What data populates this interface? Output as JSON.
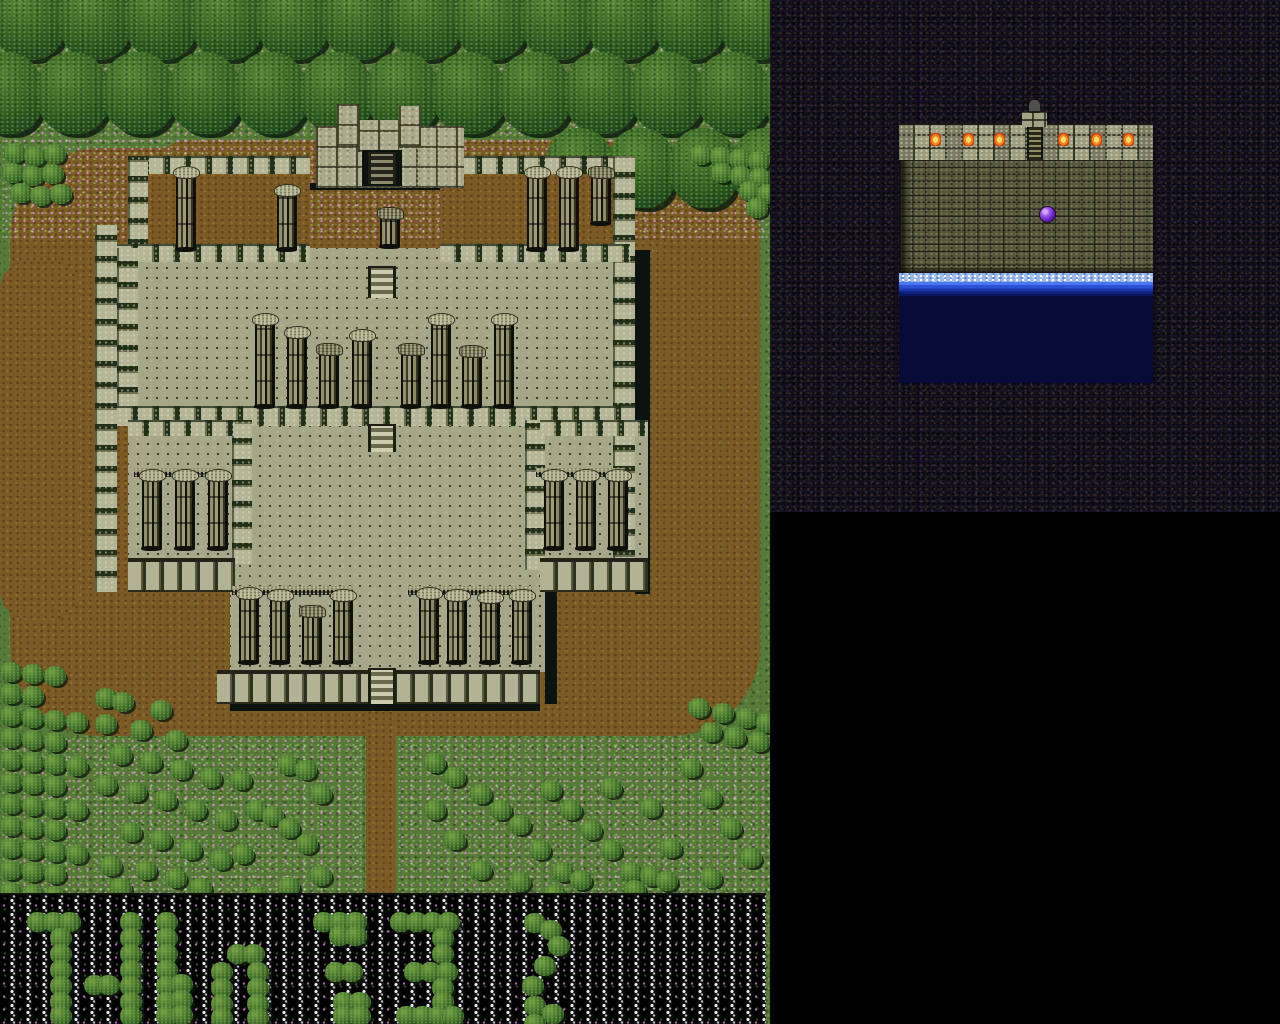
{
  "screen": {
    "width": 1280,
    "height": 1024
  },
  "palette": {
    "grass": "#57793a",
    "dirt": "#7a5a25",
    "tree_dark": "#173819",
    "tree_light": "#568536",
    "stone_light": "#b4b496",
    "stone_mid": "#a6a689",
    "stone_dark": "#585840",
    "shadow": "#0c130e",
    "cave_base": "#151120",
    "brick": "#56563c",
    "water_deep": "#070b36",
    "water_bright": "#2c50d4",
    "foam": "#9cb8ea",
    "orb_purple": "#6b20c0",
    "torch_flame": "#f08622",
    "flower_pink": "#d78cd2",
    "flowerbed_black": "#040404",
    "flowerbed_star": "#eeeeee"
  },
  "overworld": {
    "x": 0,
    "y": 0,
    "width": 770,
    "height": 1024,
    "terrain": {
      "dirt_areas": [
        {
          "x": 10,
          "y": 148,
          "w": 750,
          "h": 588,
          "r": 90
        },
        {
          "x": 0,
          "y": 260,
          "w": 80,
          "h": 360,
          "r": 30
        },
        {
          "x": 150,
          "y": 140,
          "w": 520,
          "h": 120,
          "r": 40
        },
        {
          "x": 366,
          "y": 704,
          "w": 30,
          "h": 190,
          "r": 0
        }
      ],
      "flower_bands": [
        {
          "x": 0,
          "y": 0,
          "w": 770,
          "h": 240
        },
        {
          "x": 0,
          "y": 736,
          "w": 366,
          "h": 157
        },
        {
          "x": 396,
          "y": 736,
          "w": 374,
          "h": 157
        }
      ],
      "tree_rows": [
        {
          "x": -8,
          "y": -22,
          "cols": 12,
          "step": 66,
          "w": 74,
          "h": 82
        },
        {
          "x": -30,
          "y": 52,
          "cols": 13,
          "step": 66,
          "w": 74,
          "h": 82
        },
        {
          "x": 545,
          "y": 128,
          "cols": 4,
          "step": 62,
          "w": 70,
          "h": 80
        }
      ],
      "flowerbed_strip": {
        "x": 0,
        "y": 893,
        "w": 766,
        "h": 131
      }
    },
    "castle": {
      "sections": [
        {
          "t": "crenelv",
          "x": 95,
          "y": 225,
          "w": 22,
          "h": 367
        },
        {
          "t": "shadow",
          "x": 635,
          "y": 250,
          "w": 15,
          "h": 344
        },
        {
          "t": "shadow",
          "x": 545,
          "y": 592,
          "w": 12,
          "h": 112
        },
        {
          "t": "shadow",
          "x": 230,
          "y": 704,
          "w": 310,
          "h": 7
        },
        {
          "t": "shadow",
          "x": 305,
          "y": 183,
          "w": 165,
          "h": 7
        },
        {
          "t": "dirtfloor",
          "x": 128,
          "y": 163,
          "w": 182,
          "h": 92
        },
        {
          "t": "dirtfloor",
          "x": 440,
          "y": 163,
          "w": 173,
          "h": 92
        },
        {
          "t": "floor",
          "x": 117,
          "y": 248,
          "w": 518,
          "h": 162
        },
        {
          "t": "floor",
          "x": 230,
          "y": 426,
          "w": 315,
          "h": 246
        },
        {
          "t": "floor",
          "x": 128,
          "y": 424,
          "w": 107,
          "h": 140
        },
        {
          "t": "floor",
          "x": 540,
          "y": 424,
          "w": 108,
          "h": 140
        },
        {
          "t": "crenelh",
          "x": 128,
          "y": 156,
          "w": 182,
          "h": 18
        },
        {
          "t": "crenelh",
          "x": 440,
          "y": 156,
          "w": 173,
          "h": 18
        },
        {
          "t": "crenelv",
          "x": 128,
          "y": 156,
          "w": 20,
          "h": 104
        },
        {
          "t": "crenelv",
          "x": 613,
          "y": 156,
          "w": 22,
          "h": 436
        },
        {
          "t": "crenelh",
          "x": 117,
          "y": 244,
          "w": 193,
          "h": 18
        },
        {
          "t": "crenelh",
          "x": 440,
          "y": 244,
          "w": 190,
          "h": 18
        },
        {
          "t": "crenelv",
          "x": 117,
          "y": 248,
          "w": 21,
          "h": 160
        },
        {
          "t": "crenelh",
          "x": 117,
          "y": 406,
          "w": 518,
          "h": 20
        },
        {
          "t": "crenelv",
          "x": 232,
          "y": 420,
          "w": 20,
          "h": 144
        },
        {
          "t": "crenelv",
          "x": 525,
          "y": 420,
          "w": 20,
          "h": 150
        },
        {
          "t": "crenelh",
          "x": 128,
          "y": 420,
          "w": 107,
          "h": 16
        },
        {
          "t": "crenelh",
          "x": 540,
          "y": 420,
          "w": 108,
          "h": 16
        },
        {
          "t": "wallface",
          "x": 128,
          "y": 558,
          "w": 107,
          "h": 34
        },
        {
          "t": "wallface",
          "x": 540,
          "y": 558,
          "w": 108,
          "h": 34
        },
        {
          "t": "wallface",
          "x": 217,
          "y": 670,
          "w": 323,
          "h": 34
        },
        {
          "t": "blocks",
          "x": 316,
          "y": 126,
          "w": 148,
          "h": 62
        },
        {
          "t": "blocks",
          "x": 337,
          "y": 104,
          "w": 22,
          "h": 42
        },
        {
          "t": "blocks",
          "x": 399,
          "y": 106,
          "w": 22,
          "h": 40
        },
        {
          "t": "blocks",
          "x": 358,
          "y": 120,
          "w": 41,
          "h": 32
        },
        {
          "t": "gate",
          "x": 362,
          "y": 150,
          "w": 40,
          "h": 36
        }
      ],
      "lintels": [
        {
          "x": 134,
          "y": 468,
          "w": 88,
          "h": 9
        },
        {
          "x": 536,
          "y": 468,
          "w": 88,
          "h": 9
        },
        {
          "x": 232,
          "y": 586,
          "w": 122,
          "h": 9
        },
        {
          "x": 408,
          "y": 586,
          "w": 124,
          "h": 9
        }
      ],
      "columns": [
        {
          "x": 176,
          "y": 175,
          "h": 74
        },
        {
          "x": 277,
          "y": 193,
          "h": 56
        },
        {
          "x": 527,
          "y": 175,
          "h": 74
        },
        {
          "x": 559,
          "y": 175,
          "h": 74
        },
        {
          "x": 591,
          "y": 175,
          "h": 48,
          "broken": true
        },
        {
          "x": 380,
          "y": 216,
          "h": 30,
          "broken": true
        },
        {
          "x": 255,
          "y": 322,
          "h": 84
        },
        {
          "x": 287,
          "y": 335,
          "h": 71
        },
        {
          "x": 319,
          "y": 352,
          "h": 54,
          "broken": true
        },
        {
          "x": 352,
          "y": 338,
          "h": 68
        },
        {
          "x": 401,
          "y": 352,
          "h": 54,
          "broken": true
        },
        {
          "x": 431,
          "y": 322,
          "h": 84
        },
        {
          "x": 462,
          "y": 354,
          "h": 52,
          "broken": true
        },
        {
          "x": 494,
          "y": 322,
          "h": 84
        },
        {
          "x": 142,
          "y": 478,
          "h": 70
        },
        {
          "x": 175,
          "y": 478,
          "h": 70
        },
        {
          "x": 208,
          "y": 478,
          "h": 70
        },
        {
          "x": 544,
          "y": 478,
          "h": 70
        },
        {
          "x": 576,
          "y": 478,
          "h": 70
        },
        {
          "x": 608,
          "y": 478,
          "h": 70
        },
        {
          "x": 239,
          "y": 596,
          "h": 66
        },
        {
          "x": 270,
          "y": 598,
          "h": 64
        },
        {
          "x": 302,
          "y": 614,
          "h": 48,
          "broken": true
        },
        {
          "x": 333,
          "y": 598,
          "h": 64
        },
        {
          "x": 419,
          "y": 596,
          "h": 66
        },
        {
          "x": 447,
          "y": 598,
          "h": 64
        },
        {
          "x": 480,
          "y": 600,
          "h": 62
        },
        {
          "x": 512,
          "y": 598,
          "h": 64
        }
      ],
      "stairs": [
        {
          "x": 368,
          "y": 152,
          "w": 28,
          "h": 32,
          "dark": true
        },
        {
          "x": 368,
          "y": 266,
          "w": 28,
          "h": 32
        },
        {
          "x": 368,
          "y": 424,
          "w": 28,
          "h": 28
        },
        {
          "x": 368,
          "y": 668,
          "w": 28,
          "h": 36
        }
      ]
    },
    "bushes": [
      [
        4,
        143
      ],
      [
        24,
        146
      ],
      [
        44,
        144
      ],
      [
        2,
        163
      ],
      [
        22,
        166
      ],
      [
        42,
        164
      ],
      [
        10,
        183
      ],
      [
        30,
        186
      ],
      [
        50,
        184
      ],
      [
        690,
        145
      ],
      [
        710,
        147
      ],
      [
        729,
        149
      ],
      [
        748,
        151
      ],
      [
        711,
        163
      ],
      [
        730,
        166
      ],
      [
        749,
        168
      ],
      [
        739,
        181
      ],
      [
        757,
        184
      ],
      [
        746,
        198
      ],
      [
        0,
        662
      ],
      [
        22,
        664
      ],
      [
        44,
        666
      ],
      [
        0,
        684
      ],
      [
        22,
        686
      ],
      [
        0,
        706
      ],
      [
        22,
        708
      ],
      [
        44,
        710
      ],
      [
        66,
        712
      ],
      [
        0,
        728
      ],
      [
        22,
        730
      ],
      [
        44,
        732
      ],
      [
        0,
        750
      ],
      [
        22,
        752
      ],
      [
        44,
        754
      ],
      [
        66,
        756
      ],
      [
        0,
        772
      ],
      [
        22,
        774
      ],
      [
        44,
        776
      ],
      [
        0,
        794
      ],
      [
        22,
        796
      ],
      [
        44,
        798
      ],
      [
        66,
        800
      ],
      [
        0,
        816
      ],
      [
        22,
        818
      ],
      [
        44,
        820
      ],
      [
        0,
        838
      ],
      [
        22,
        840
      ],
      [
        44,
        842
      ],
      [
        66,
        844
      ],
      [
        0,
        860
      ],
      [
        22,
        862
      ],
      [
        44,
        864
      ],
      [
        0,
        882
      ],
      [
        22,
        884
      ],
      [
        44,
        886
      ],
      [
        95,
        688
      ],
      [
        112,
        692
      ],
      [
        150,
        700
      ],
      [
        95,
        714
      ],
      [
        130,
        720
      ],
      [
        165,
        730
      ],
      [
        110,
        745
      ],
      [
        140,
        752
      ],
      [
        170,
        760
      ],
      [
        200,
        768
      ],
      [
        95,
        775
      ],
      [
        125,
        782
      ],
      [
        155,
        790
      ],
      [
        185,
        800
      ],
      [
        215,
        810
      ],
      [
        120,
        822
      ],
      [
        150,
        830
      ],
      [
        180,
        840
      ],
      [
        210,
        850
      ],
      [
        135,
        860
      ],
      [
        165,
        868
      ],
      [
        100,
        856
      ],
      [
        230,
        770
      ],
      [
        246,
        800
      ],
      [
        262,
        806
      ],
      [
        278,
        818
      ],
      [
        296,
        834
      ],
      [
        232,
        844
      ],
      [
        310,
        866
      ],
      [
        278,
        877
      ],
      [
        246,
        886
      ],
      [
        277,
        755
      ],
      [
        295,
        760
      ],
      [
        310,
        784
      ],
      [
        110,
        878
      ],
      [
        190,
        878
      ],
      [
        424,
        753
      ],
      [
        444,
        767
      ],
      [
        470,
        784
      ],
      [
        490,
        800
      ],
      [
        509,
        815
      ],
      [
        444,
        830
      ],
      [
        529,
        840
      ],
      [
        470,
        860
      ],
      [
        509,
        872
      ],
      [
        552,
        862
      ],
      [
        570,
        870
      ],
      [
        620,
        862
      ],
      [
        640,
        866
      ],
      [
        656,
        871
      ],
      [
        600,
        778
      ],
      [
        640,
        798
      ],
      [
        680,
        758
      ],
      [
        700,
        788
      ],
      [
        720,
        818
      ],
      [
        660,
        838
      ],
      [
        740,
        848
      ],
      [
        700,
        868
      ],
      [
        424,
        800
      ],
      [
        540,
        780
      ],
      [
        560,
        800
      ],
      [
        580,
        820
      ],
      [
        600,
        840
      ],
      [
        624,
        880
      ],
      [
        544,
        884
      ],
      [
        688,
        698
      ],
      [
        712,
        703
      ],
      [
        736,
        708
      ],
      [
        756,
        713
      ],
      [
        700,
        722
      ],
      [
        724,
        727
      ],
      [
        748,
        732
      ]
    ],
    "flowerbed_bushes": [
      [
        27,
        912
      ],
      [
        43,
        912
      ],
      [
        59,
        912
      ],
      [
        50,
        928
      ],
      [
        50,
        944
      ],
      [
        50,
        960
      ],
      [
        50,
        976
      ],
      [
        50,
        992
      ],
      [
        50,
        1006
      ],
      [
        84,
        975
      ],
      [
        98,
        975
      ],
      [
        120,
        912
      ],
      [
        120,
        928
      ],
      [
        120,
        944
      ],
      [
        120,
        960
      ],
      [
        120,
        976
      ],
      [
        120,
        992
      ],
      [
        120,
        1006
      ],
      [
        156,
        912
      ],
      [
        156,
        928
      ],
      [
        156,
        944
      ],
      [
        156,
        960
      ],
      [
        156,
        976
      ],
      [
        156,
        992
      ],
      [
        156,
        1006
      ],
      [
        171,
        974
      ],
      [
        171,
        990
      ],
      [
        171,
        1005
      ],
      [
        227,
        944
      ],
      [
        243,
        944
      ],
      [
        211,
        962
      ],
      [
        211,
        978
      ],
      [
        211,
        994
      ],
      [
        211,
        1008
      ],
      [
        247,
        962
      ],
      [
        247,
        978
      ],
      [
        247,
        994
      ],
      [
        247,
        1008
      ],
      [
        313,
        912
      ],
      [
        329,
        912
      ],
      [
        345,
        912
      ],
      [
        329,
        926
      ],
      [
        345,
        926
      ],
      [
        325,
        962
      ],
      [
        341,
        962
      ],
      [
        333,
        992
      ],
      [
        349,
        992
      ],
      [
        333,
        1006
      ],
      [
        349,
        1006
      ],
      [
        390,
        912
      ],
      [
        406,
        912
      ],
      [
        422,
        912
      ],
      [
        438,
        912
      ],
      [
        432,
        928
      ],
      [
        432,
        944
      ],
      [
        404,
        962
      ],
      [
        420,
        962
      ],
      [
        436,
        962
      ],
      [
        432,
        978
      ],
      [
        432,
        992
      ],
      [
        396,
        1006
      ],
      [
        412,
        1006
      ],
      [
        428,
        1006
      ],
      [
        442,
        1006
      ],
      [
        524,
        913
      ],
      [
        540,
        920
      ],
      [
        548,
        936
      ],
      [
        534,
        956
      ],
      [
        522,
        976
      ],
      [
        524,
        996
      ],
      [
        542,
        1004
      ],
      [
        524,
        1014
      ]
    ]
  },
  "side_view": {
    "cave_panel": {
      "x": 770,
      "y": 0,
      "w": 510,
      "h": 512
    },
    "black_area": {
      "x": 770,
      "y": 512,
      "w": 510,
      "h": 512
    },
    "room": {
      "x": 899,
      "y": 100,
      "w": 254,
      "h": 283,
      "wall_band": {
        "x": 0,
        "y": 23,
        "w": 254,
        "h": 37
      },
      "torches": {
        "count": 6,
        "centers_x": [
          36,
          69,
          100,
          164,
          197,
          229
        ],
        "top_y": 33
      },
      "chimney": {
        "x": 123,
        "y": 12,
        "w": 25,
        "h": 15
      },
      "chimney_cap": {
        "x": 130,
        "y": 0,
        "w": 11,
        "h": 13
      },
      "ladder": {
        "x": 128,
        "y": 27,
        "w": 16,
        "h": 45
      },
      "bricks": {
        "x": 0,
        "y": 60,
        "w": 254,
        "h": 113
      },
      "orb": {
        "x": 141,
        "y": 107,
        "size": 15,
        "color": "#6b20c0"
      },
      "water_foam": {
        "x": 0,
        "y": 173,
        "w": 254,
        "h": 9
      },
      "water_surface": {
        "x": 0,
        "y": 182,
        "w": 254,
        "h": 14
      },
      "deep_water": {
        "x": 0,
        "y": 196,
        "w": 254,
        "h": 87
      }
    }
  }
}
